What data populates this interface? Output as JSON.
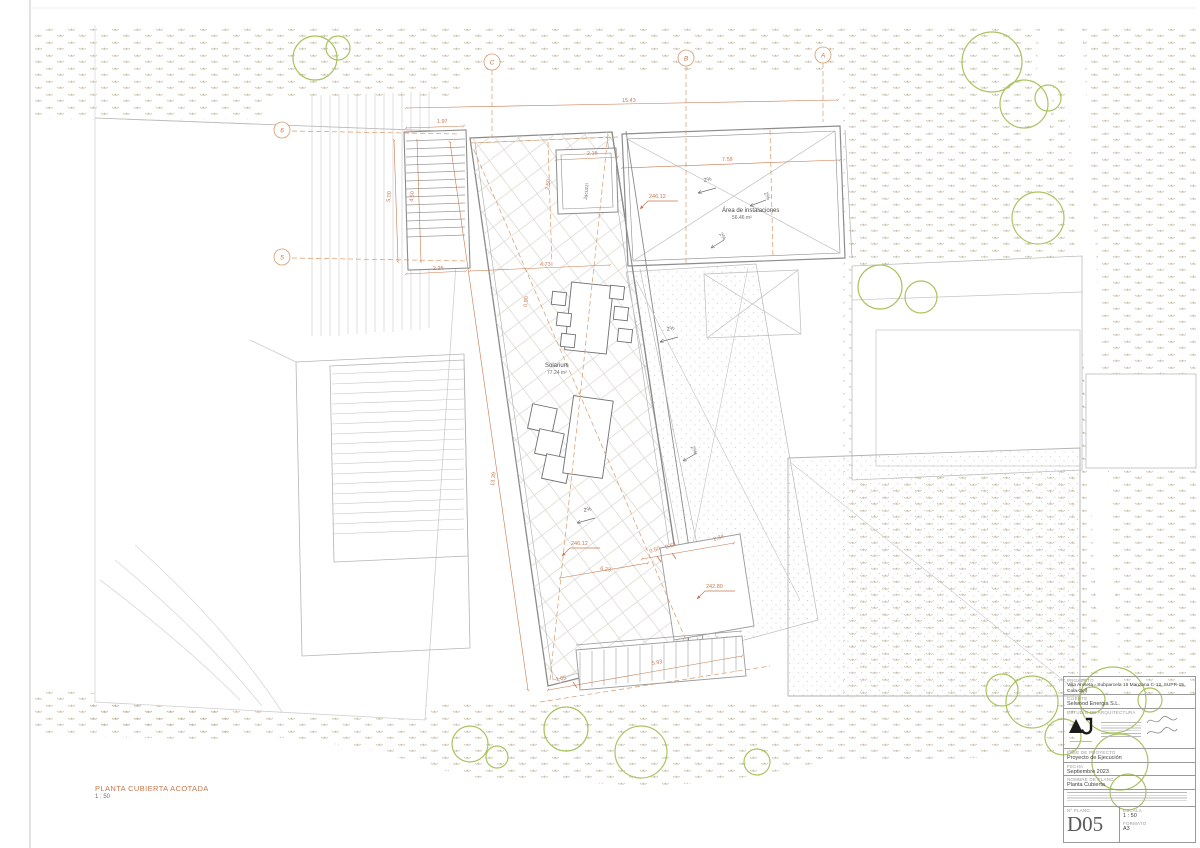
{
  "sheet": {
    "view_title": "PLANTA CUBIERTA ACOTADA",
    "view_scale": "1 : 50"
  },
  "colors": {
    "annotation_orange": "#c8794f",
    "tree_green": "#a9c45e",
    "terrain_hatch_tan": "#bdb49a",
    "drawing_gray": "#8c8c8c"
  },
  "drawing": {
    "grid": {
      "top": [
        "C",
        "B",
        "A"
      ],
      "left": [
        "6",
        "5"
      ]
    },
    "annotations": [
      {
        "t": "15.43",
        "x": 622,
        "y": 102,
        "r": -1,
        "c": "dim"
      },
      {
        "t": "1.97",
        "x": 437,
        "y": 123,
        "r": -2,
        "c": "dim"
      },
      {
        "t": "5.00",
        "x": 390,
        "y": 202,
        "r": -83,
        "c": "dim"
      },
      {
        "t": "4.50",
        "x": 413,
        "y": 202,
        "r": -83,
        "c": "dim"
      },
      {
        "t": "2.50",
        "x": 549,
        "y": 190,
        "r": -83,
        "c": "dim"
      },
      {
        "t": "2.16",
        "x": 587,
        "y": 155,
        "r": -2,
        "c": "dim"
      },
      {
        "t": "7.59",
        "x": 722,
        "y": 161,
        "r": -2,
        "c": "dim"
      },
      {
        "t": "2.25",
        "x": 433,
        "y": 270,
        "r": -2,
        "c": "dim"
      },
      {
        "t": "4.73",
        "x": 540,
        "y": 266,
        "r": -2,
        "c": "dim"
      },
      {
        "t": "0.90",
        "x": 527,
        "y": 307,
        "r": -83,
        "c": "dim"
      },
      {
        "t": "13.39",
        "x": 494,
        "y": 486,
        "r": -83,
        "c": "dim"
      },
      {
        "t": "6.23",
        "x": 600,
        "y": 570,
        "r": 8,
        "c": "dim"
      },
      {
        "t": "0.50",
        "x": 650,
        "y": 553,
        "r": -18,
        "c": "dim"
      },
      {
        "t": "0.63",
        "x": 666,
        "y": 549,
        "r": -18,
        "c": "dim"
      },
      {
        "t": "2.34",
        "x": 714,
        "y": 541,
        "r": -18,
        "c": "dim"
      },
      {
        "t": "1.05",
        "x": 556,
        "y": 681,
        "r": -10,
        "c": "dim"
      },
      {
        "t": "5.93",
        "x": 652,
        "y": 665,
        "r": -10,
        "c": "dim"
      },
      {
        "t": "246.12",
        "x": 649,
        "y": 198,
        "r": 0,
        "c": "level"
      },
      {
        "t": "246.12",
        "x": 571,
        "y": 545,
        "r": 0,
        "c": "level"
      },
      {
        "t": "242.80",
        "x": 706,
        "y": 588,
        "r": 0,
        "c": "level"
      },
      {
        "t": "2%",
        "x": 704,
        "y": 182,
        "r": -12,
        "c": "slope"
      },
      {
        "t": "2%",
        "x": 764,
        "y": 193,
        "r": 65,
        "c": "slope"
      },
      {
        "t": "2%",
        "x": 719,
        "y": 234,
        "r": 55,
        "c": "slope"
      },
      {
        "t": "2%",
        "x": 667,
        "y": 331,
        "r": -12,
        "c": "slope"
      },
      {
        "t": "2%",
        "x": 691,
        "y": 447,
        "r": 65,
        "c": "slope"
      },
      {
        "t": "2%",
        "x": 584,
        "y": 512,
        "r": -12,
        "c": "slope"
      },
      {
        "t": "Área de instalaciones",
        "x": 722,
        "y": 212,
        "r": 0,
        "c": "lbl"
      },
      {
        "t": "56.46 m²",
        "x": 732,
        "y": 219,
        "r": 0,
        "c": "lblsm"
      },
      {
        "t": "Solarium",
        "x": 545,
        "y": 367,
        "r": 0,
        "c": "lbl"
      },
      {
        "t": "77.24 m²",
        "x": 547,
        "y": 374,
        "r": 0,
        "c": "lblsm"
      },
      {
        "t": "Jacuzzi",
        "x": 587,
        "y": 200,
        "r": -85,
        "c": "lblsm"
      }
    ]
  },
  "title_block": {
    "project_label": "PROYECTO",
    "project": "Villa Aniseta - Subparcela 15 Manzana C-12, SUPR-15, Cala Golf",
    "client_label": "CLIENTE",
    "client": "Selwood Energia S.L.",
    "studio_label": "ESTUDIO DE ARQUITECTURA",
    "studio_logo": "AJ",
    "phase_label": "FASE DE PROYECTO",
    "phase": "Proyecto de Ejecución",
    "date_label": "FECHA",
    "date": "Septiembre 2023",
    "sheet_name_label": "NOMBRE DE PLANO",
    "sheet_name": "Planta Cubierta",
    "number_label": "Nº PLANO",
    "number": "D05",
    "scale_label": "ESCALA",
    "scale": "1 : 50",
    "format_label": "FORMATO",
    "format": "A3"
  }
}
